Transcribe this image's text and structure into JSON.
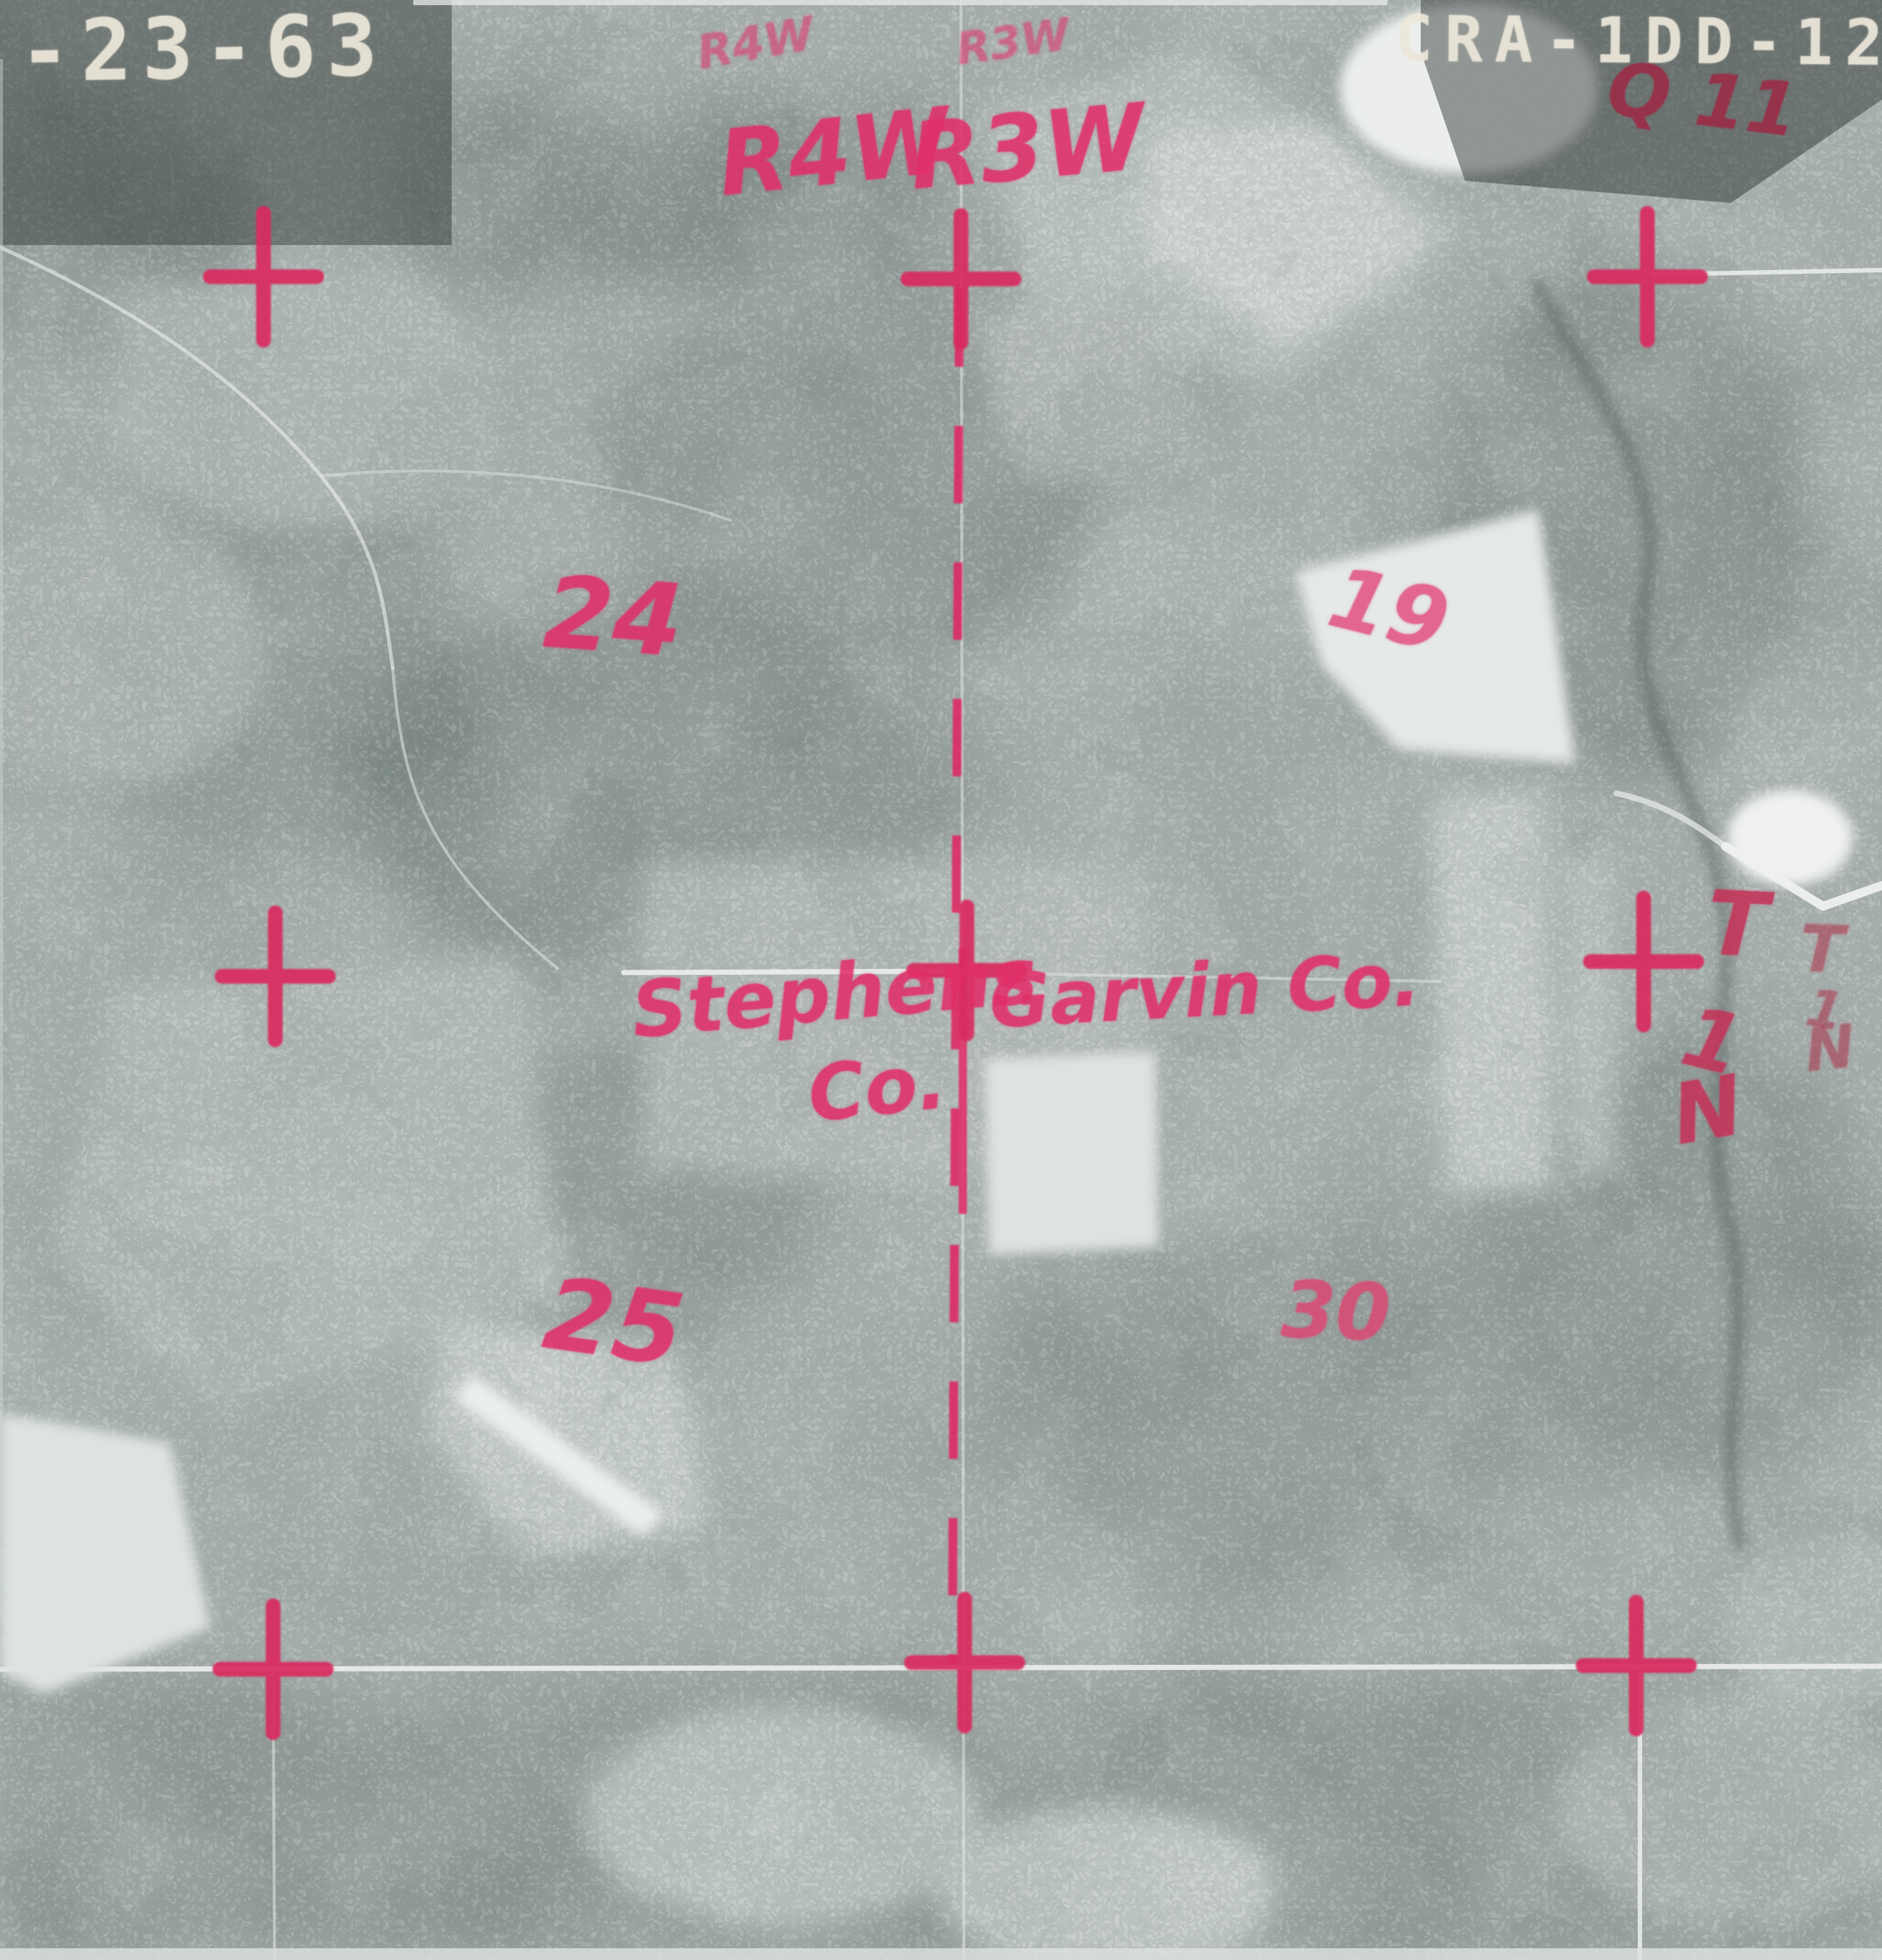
{
  "stamps": {
    "date_code": "-23-63",
    "photo_id": "CRA-1DD-127"
  },
  "annotations": {
    "q_note": "Q 11",
    "range": {
      "bold_left": "R4W",
      "bold_right": "R3W",
      "faint_left": "R4W",
      "faint_right": "R3W"
    },
    "sections": {
      "nw": "24",
      "ne": "19",
      "sw": "25",
      "se": "30"
    },
    "counties": {
      "left_line1": "Stephens",
      "left_line2": "Co.",
      "right": "Garvin Co."
    },
    "township_bold": {
      "t": "T",
      "one": "1",
      "n": "N"
    },
    "township_faint": {
      "t": "T",
      "one": "1",
      "n": "N"
    }
  },
  "colors": {
    "marker_pink": "#e12e68",
    "marker_crimson": "#9c2945",
    "cross_red": "#d92a5e",
    "stamp_white": "#ece7d9",
    "photo_base": "#9aa4a1",
    "road_white": "#eef1ef"
  }
}
